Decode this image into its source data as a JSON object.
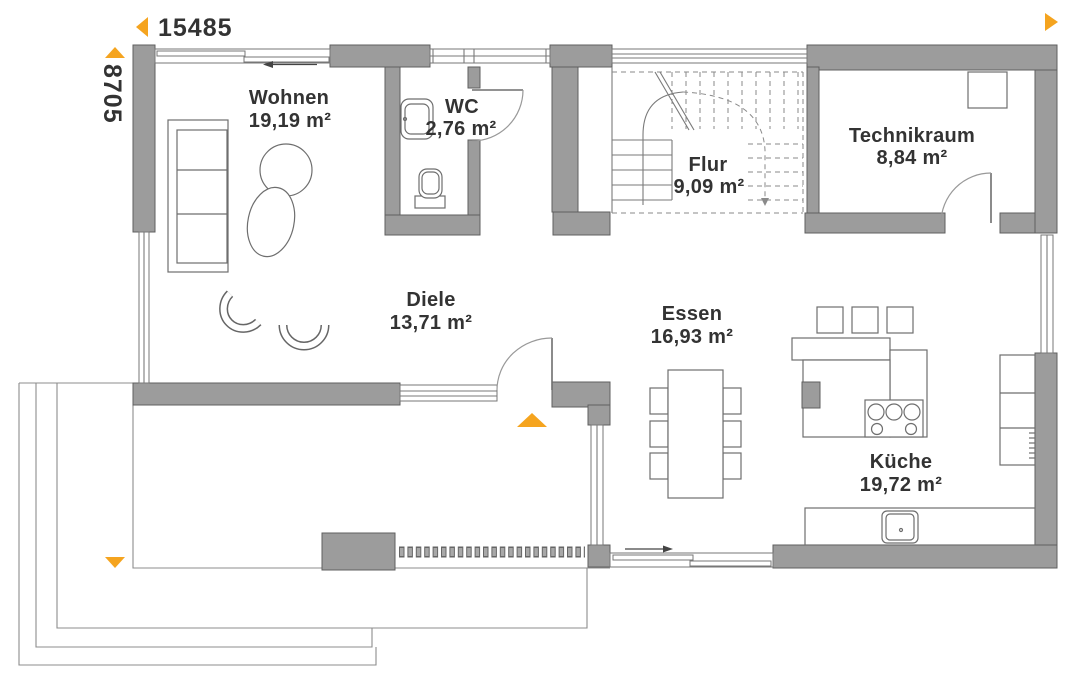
{
  "plan": {
    "title": "Grundriss Erdgeschoss",
    "dimensions": {
      "width": "15485",
      "height": "8705"
    },
    "rooms": [
      {
        "id": "wohnen",
        "name": "Wohnen",
        "area": "19,19 m²"
      },
      {
        "id": "wc",
        "name": "WC",
        "area": "2,76 m²"
      },
      {
        "id": "flur",
        "name": "Flur",
        "area": "9,09 m²"
      },
      {
        "id": "technikraum",
        "name": "Technikraum",
        "area": "8,84 m²"
      },
      {
        "id": "diele",
        "name": "Diele",
        "area": "13,71 m²"
      },
      {
        "id": "essen",
        "name": "Essen",
        "area": "16,93 m²"
      },
      {
        "id": "kueche",
        "name": "Küche",
        "area": "19,72 m²"
      }
    ],
    "colors": {
      "wall": "#9c9c9c",
      "wall_outline": "#5f5f5f",
      "accent_orange": "#F5A41F",
      "text": "#333333",
      "thin_line": "#7a7a7a",
      "dashed_line": "#8a8a8a"
    }
  }
}
